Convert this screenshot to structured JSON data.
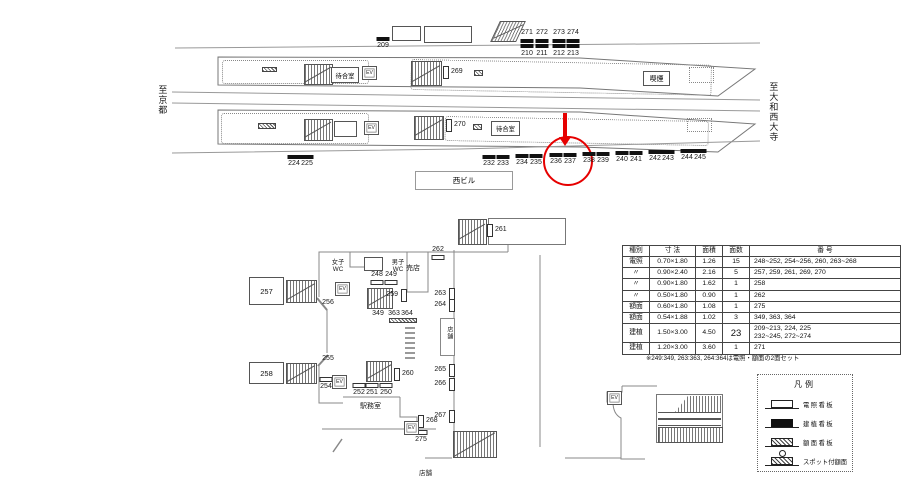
{
  "labels": {
    "to_kyoto": "至京都",
    "to_saidaiji": "至大和西大寺",
    "west_building": "西ビル",
    "smoking": "喫煙",
    "waiting": "待合室",
    "ev": "EV",
    "women_wc": "女子\nWC",
    "men_wc": "男子\nWC",
    "kiosk": "売店",
    "office": "駅務室",
    "shop_mid": "店舗",
    "shop_bottom": "店舗"
  },
  "platform_signs": {
    "single_black": [
      {
        "label": "209",
        "x": 383,
        "y": 37
      },
      {
        "label": "224",
        "x": 294,
        "y": 155
      },
      {
        "label": "225",
        "x": 307,
        "y": 155
      },
      {
        "label": "232",
        "x": 489,
        "y": 155
      },
      {
        "label": "233",
        "x": 503,
        "y": 155
      },
      {
        "label": "234",
        "x": 522,
        "y": 154
      },
      {
        "label": "235",
        "x": 536,
        "y": 154
      },
      {
        "label": "236",
        "x": 556,
        "y": 153
      },
      {
        "label": "237",
        "x": 570,
        "y": 153
      },
      {
        "label": "238",
        "x": 589,
        "y": 152
      },
      {
        "label": "239",
        "x": 603,
        "y": 152
      },
      {
        "label": "240",
        "x": 622,
        "y": 151
      },
      {
        "label": "241",
        "x": 636,
        "y": 151
      },
      {
        "label": "242",
        "x": 655,
        "y": 150
      },
      {
        "label": "243",
        "x": 668,
        "y": 150
      },
      {
        "label": "244",
        "x": 687,
        "y": 149
      },
      {
        "label": "245",
        "x": 700,
        "y": 149
      }
    ],
    "double_black": [
      {
        "top": "271",
        "bottom": "210",
        "x": 527
      },
      {
        "top": "272",
        "bottom": "211",
        "x": 542
      },
      {
        "top": "273",
        "bottom": "212",
        "x": 559
      },
      {
        "top": "274",
        "bottom": "213",
        "x": 573
      }
    ]
  },
  "concourse_signs": {
    "white_bars": [
      {
        "label": "248",
        "x": 377,
        "y": 280,
        "labelPos": "above"
      },
      {
        "label": "249",
        "x": 391,
        "y": 280,
        "labelPos": "above"
      },
      {
        "label": "252",
        "x": 359,
        "y": 383,
        "labelPos": "below"
      },
      {
        "label": "251",
        "x": 372,
        "y": 383,
        "labelPos": "below"
      },
      {
        "label": "250",
        "x": 386,
        "y": 383,
        "labelPos": "below"
      },
      {
        "label": "254",
        "x": 326,
        "y": 377,
        "labelPos": "below"
      },
      {
        "label": "262",
        "x": 438,
        "y": 255,
        "labelPos": "above"
      },
      {
        "label": "275",
        "x": 421,
        "y": 430,
        "labelPos": "below"
      }
    ],
    "brackets": [
      {
        "label": "269",
        "x": 443,
        "y": 66,
        "side": "right"
      },
      {
        "label": "270",
        "x": 446,
        "y": 119,
        "side": "right"
      },
      {
        "label": "259",
        "x": 401,
        "y": 289,
        "side": "left"
      },
      {
        "label": "260",
        "x": 394,
        "y": 368,
        "side": "right"
      },
      {
        "label": "261",
        "x": 487,
        "y": 224,
        "side": "right"
      },
      {
        "label": "263",
        "x": 449,
        "y": 288,
        "side": "left"
      },
      {
        "label": "264",
        "x": 449,
        "y": 299,
        "side": "left"
      },
      {
        "label": "265",
        "x": 449,
        "y": 364,
        "side": "left"
      },
      {
        "label": "266",
        "x": 449,
        "y": 378,
        "side": "left"
      },
      {
        "label": "267",
        "x": 449,
        "y": 410,
        "side": "left"
      },
      {
        "label": "268",
        "x": 418,
        "y": 415,
        "side": "right"
      }
    ],
    "plain": [
      {
        "label": "256",
        "x": 328,
        "y": 299
      },
      {
        "label": "255",
        "x": 328,
        "y": 355
      },
      {
        "label": "349",
        "x": 378,
        "y": 310
      },
      {
        "label": "363",
        "x": 394,
        "y": 310
      },
      {
        "label": "364",
        "x": 407,
        "y": 310
      }
    ],
    "rooms": [
      {
        "label": "257",
        "x": 249,
        "y": 277,
        "w": 35,
        "h": 28
      },
      {
        "label": "258",
        "x": 249,
        "y": 362,
        "w": 35,
        "h": 22
      }
    ]
  },
  "ev_positions": [
    {
      "x": 362,
      "y": 66
    },
    {
      "x": 364,
      "y": 121
    },
    {
      "x": 335,
      "y": 282
    },
    {
      "x": 332,
      "y": 375
    },
    {
      "x": 404,
      "y": 421
    },
    {
      "x": 607,
      "y": 391
    }
  ],
  "table": {
    "headers": [
      "種別",
      "寸 法",
      "面積",
      "面数",
      "番 号"
    ],
    "rows": [
      {
        "type": "電照",
        "size": "0.70×1.80",
        "area": "1.26",
        "count": "15",
        "numbers": "248~252, 254~256, 260, 263~268",
        "big": false
      },
      {
        "type": "〃",
        "size": "0.90×2.40",
        "area": "2.16",
        "count": "5",
        "numbers": "257, 259, 261, 269, 270",
        "big": false
      },
      {
        "type": "〃",
        "size": "0.90×1.80",
        "area": "1.62",
        "count": "1",
        "numbers": "258",
        "big": false
      },
      {
        "type": "〃",
        "size": "0.50×1.80",
        "area": "0.90",
        "count": "1",
        "numbers": "262",
        "big": false
      },
      {
        "type": "額面",
        "size": "0.60×1.80",
        "area": "1.08",
        "count": "1",
        "numbers": "275",
        "big": false
      },
      {
        "type": "額面",
        "size": "0.54×1.88",
        "area": "1.02",
        "count": "3",
        "numbers": "349, 363, 364",
        "big": false
      },
      {
        "type": "建植",
        "size": "1.50×3.00",
        "area": "4.50",
        "count": "23",
        "numbers": "209~213, 224, 225\n232~245, 272~274",
        "big": true
      },
      {
        "type": "建植",
        "size": "1.20×3.00",
        "area": "3.60",
        "count": "1",
        "numbers": "271",
        "big": false
      }
    ],
    "footnote": "※249:349, 263:363, 264:364は電照・額面の2面セット"
  },
  "legend": {
    "title": "凡例",
    "items": [
      {
        "label": "電照看板",
        "type": "lg-illum",
        "tight": false
      },
      {
        "label": "建植看板",
        "type": "lg-stand",
        "tight": false
      },
      {
        "label": "額面看板",
        "type": "lg-face",
        "tight": false
      },
      {
        "label": "スポット付額面",
        "type": "lg-spot",
        "tight": true
      }
    ]
  }
}
